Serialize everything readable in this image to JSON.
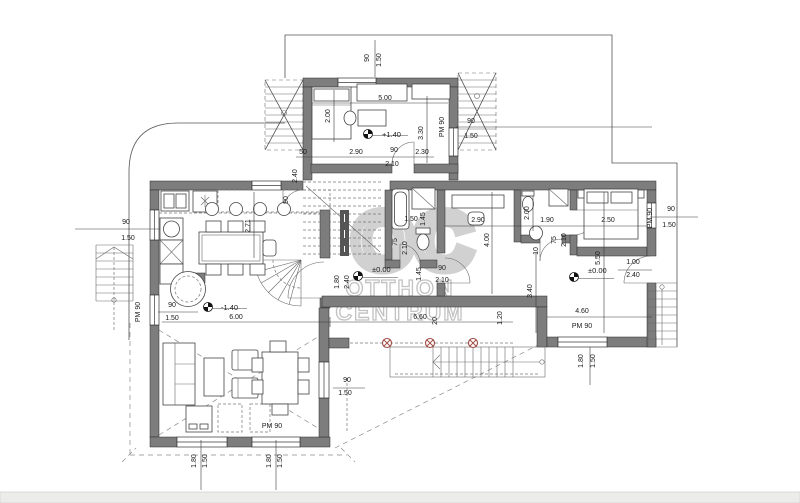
{
  "drawing": {
    "kind": "floor-plan"
  },
  "watermark": {
    "monogram": "OC",
    "line1": "OTTHON",
    "line2": "CENTRUM"
  },
  "colors": {
    "wall_fill": "#7d7d7d",
    "line": "#3a3a3a",
    "dashed": "#8a8a8a",
    "column_accent": "#9e4a42",
    "watermark_gray": "#c9c9c9",
    "page_band": "#ecece9",
    "background": "#ffffff",
    "dim_text": "#1a1a1a"
  },
  "level_markers": [
    {
      "value": "+1.40",
      "cx": 368,
      "cy": 134,
      "lx": 382,
      "ly": 137
    },
    {
      "value": "-1.40",
      "cx": 208,
      "cy": 307,
      "lx": 221,
      "ly": 310
    },
    {
      "value": "±0.00",
      "cx": 358,
      "cy": 276,
      "lx": 372,
      "ly": 272
    },
    {
      "value": "±0.00",
      "cx": 574,
      "cy": 277,
      "lx": 588,
      "ly": 273
    }
  ],
  "annotations": [
    {
      "t": "90",
      "x": 369,
      "y": 58,
      "r": -90
    },
    {
      "t": "1.50",
      "x": 381,
      "y": 60,
      "r": -90
    },
    {
      "t": "5.00",
      "x": 385,
      "y": 100
    },
    {
      "t": "2.00",
      "x": 330,
      "y": 116,
      "r": -90
    },
    {
      "t": "3.30",
      "x": 423,
      "y": 133,
      "r": -90
    },
    {
      "t": "PM 90",
      "x": 444,
      "y": 127,
      "r": -90
    },
    {
      "t": "90",
      "x": 471,
      "y": 123
    },
    {
      "t": "1.50",
      "x": 471,
      "y": 138
    },
    {
      "t": "50",
      "x": 303,
      "y": 154
    },
    {
      "t": "2.90",
      "x": 356,
      "y": 154
    },
    {
      "t": "90",
      "x": 394,
      "y": 152
    },
    {
      "t": "2.10",
      "x": 392,
      "y": 166
    },
    {
      "t": "2.30",
      "x": 422,
      "y": 154
    },
    {
      "t": "2.40",
      "x": 297,
      "y": 176,
      "r": -90
    },
    {
      "t": "90",
      "x": 288,
      "y": 200,
      "r": -90
    },
    {
      "t": "90",
      "x": 126,
      "y": 224
    },
    {
      "t": "1.50",
      "x": 128,
      "y": 240
    },
    {
      "t": "PM 90",
      "x": 140,
      "y": 312,
      "r": -90
    },
    {
      "t": "90",
      "x": 172,
      "y": 307
    },
    {
      "t": "1.50",
      "x": 172,
      "y": 320
    },
    {
      "t": "2.71",
      "x": 250,
      "y": 226,
      "r": -90
    },
    {
      "t": "6.00",
      "x": 236,
      "y": 319
    },
    {
      "t": "6.60",
      "x": 420,
      "y": 319
    },
    {
      "t": "1.80",
      "x": 339,
      "y": 282,
      "r": -90
    },
    {
      "t": "2.40",
      "x": 349,
      "y": 282,
      "r": -90
    },
    {
      "t": "90",
      "x": 442,
      "y": 270
    },
    {
      "t": "2.10",
      "x": 442,
      "y": 282
    },
    {
      "t": "1.50",
      "x": 411,
      "y": 221
    },
    {
      "t": "1.45",
      "x": 425,
      "y": 219,
      "r": -90
    },
    {
      "t": "75",
      "x": 397,
      "y": 242,
      "r": -90
    },
    {
      "t": "2.10",
      "x": 407,
      "y": 248,
      "r": -90
    },
    {
      "t": "1.45",
      "x": 421,
      "y": 274,
      "r": -90
    },
    {
      "t": "2.90",
      "x": 478,
      "y": 222
    },
    {
      "t": "4.00",
      "x": 489,
      "y": 240,
      "r": -90
    },
    {
      "t": "1.90",
      "x": 547,
      "y": 222
    },
    {
      "t": "2.00",
      "x": 529,
      "y": 213,
      "r": -90
    },
    {
      "t": "75",
      "x": 556,
      "y": 240,
      "r": -90
    },
    {
      "t": "2.10",
      "x": 566,
      "y": 240,
      "r": -90
    },
    {
      "t": "10",
      "x": 538,
      "y": 251,
      "r": -90
    },
    {
      "t": "2.50",
      "x": 608,
      "y": 222
    },
    {
      "t": "5.50",
      "x": 600,
      "y": 258,
      "r": -90
    },
    {
      "t": "PM 90",
      "x": 652,
      "y": 218,
      "r": -90
    },
    {
      "t": "90",
      "x": 671,
      "y": 211
    },
    {
      "t": "1.50",
      "x": 669,
      "y": 227
    },
    {
      "t": "1.00",
      "x": 633,
      "y": 264
    },
    {
      "t": "2.40",
      "x": 633,
      "y": 277
    },
    {
      "t": "3.40",
      "x": 532,
      "y": 291,
      "r": -90
    },
    {
      "t": "20",
      "x": 437,
      "y": 321,
      "r": -90
    },
    {
      "t": "1.20",
      "x": 502,
      "y": 318,
      "r": -90
    },
    {
      "t": "4.60",
      "x": 582,
      "y": 313
    },
    {
      "t": "PM 90",
      "x": 582,
      "y": 328
    },
    {
      "t": "1.80",
      "x": 583,
      "y": 361,
      "r": -90
    },
    {
      "t": "1.50",
      "x": 595,
      "y": 361,
      "r": -90
    },
    {
      "t": "90",
      "x": 347,
      "y": 382
    },
    {
      "t": "1.50",
      "x": 345,
      "y": 395
    },
    {
      "t": "PM 90",
      "x": 272,
      "y": 428
    },
    {
      "t": "1.80",
      "x": 196,
      "y": 461,
      "r": -90
    },
    {
      "t": "1.50",
      "x": 207,
      "y": 461,
      "r": -90
    },
    {
      "t": "1.80",
      "x": 271,
      "y": 461,
      "r": -90
    },
    {
      "t": "1.50",
      "x": 282,
      "y": 461,
      "r": -90
    }
  ]
}
